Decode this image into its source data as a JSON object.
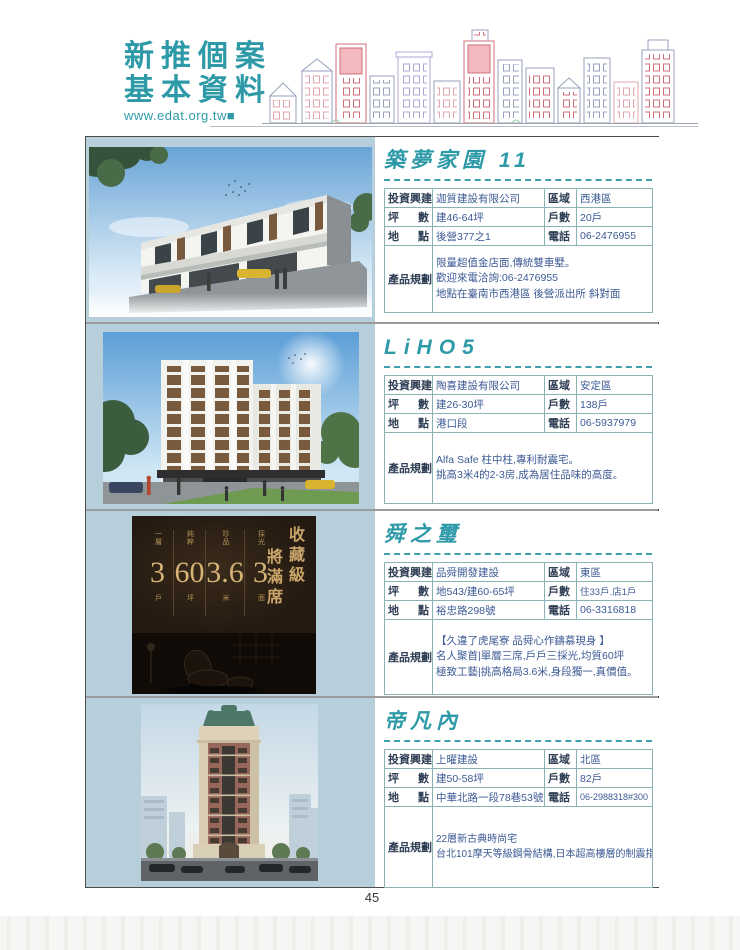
{
  "header": {
    "title_line1": "新推個案",
    "title_line2": "基本資料",
    "website": "www.edat.org.tw■",
    "accent_color": "#2e9aa8"
  },
  "table_labels": {
    "builder": "投資興建",
    "size_l": "坪",
    "size_r": "數",
    "loc_l": "地",
    "loc_r": "點",
    "region": "區域",
    "units": "戶數",
    "phone": "電話",
    "plan": "產品規劃"
  },
  "listings": [
    {
      "title": "築夢家園 11",
      "builder": "迦質建設有限公司",
      "region": "西港區",
      "size": "建46-64坪",
      "units": "20戶",
      "location": "後營377之1",
      "phone": "06-2476955",
      "plan_lines": [
        "限量超值金店面,傳統雙車墅。",
        "歡迎來電洽詢:06-2476955",
        "地點在臺南市西港區 後營派出所 斜對面"
      ]
    },
    {
      "title": "LiHO5",
      "builder": "陶喜建設有限公司",
      "region": "安定區",
      "size": "建26-30坪",
      "units": "138戶",
      "location": "港口段",
      "phone": "06-5937979",
      "plan_lines": [
        "Alfa Safe 柱中柱,專利耐震宅。",
        "挑高3米4的2-3房,成為居住品味的高度。"
      ]
    },
    {
      "title": "舜之璽",
      "builder": "品舜開發建設",
      "region": "東區",
      "size": "地543/建60-65坪",
      "units": "住33戶.店1戶",
      "location": "裕忠路298號",
      "phone": "06-3316818",
      "plan_lines": [
        "【久違了虎尾寮 品舜心作鑄慕現身 】",
        "名人聚首|單層三席,戶戶三採光,均質60坪",
        "極致工藝|挑高格局3.6米,身段獨一,真價值。"
      ]
    },
    {
      "title": "帝凡內",
      "builder": "上曜建設",
      "region": "北區",
      "size": "建50-58坪",
      "units": "82戶",
      "location": "中華北路一段78巷53號",
      "phone": "06-2988318#300",
      "plan_lines": [
        "22層新古典時尚宅",
        "台北101摩天等級鋼骨結構,日本超高樓層的制震指標,原裝進口新日鐵制震器與日立HI-BUILDAM阻尼器,利用消能裝置,耗資不斐營造無感地震的加倍安全感"
      ]
    }
  ],
  "poster": {
    "headline_col1": "收藏級",
    "headline_col2": "將滿席",
    "stats": [
      {
        "top": "一層",
        "num": "3",
        "bottom": "戶"
      },
      {
        "top": "純粹",
        "num": "60",
        "bottom": "坪"
      },
      {
        "top": "珍品",
        "num": "3.6",
        "bottom": "米"
      },
      {
        "top": "採光",
        "num": "3",
        "bottom": "面"
      }
    ],
    "logo": "品舜之璽",
    "caption": "虎尾寮 開箱落成|品舜建設|"
  },
  "page_number": "45"
}
